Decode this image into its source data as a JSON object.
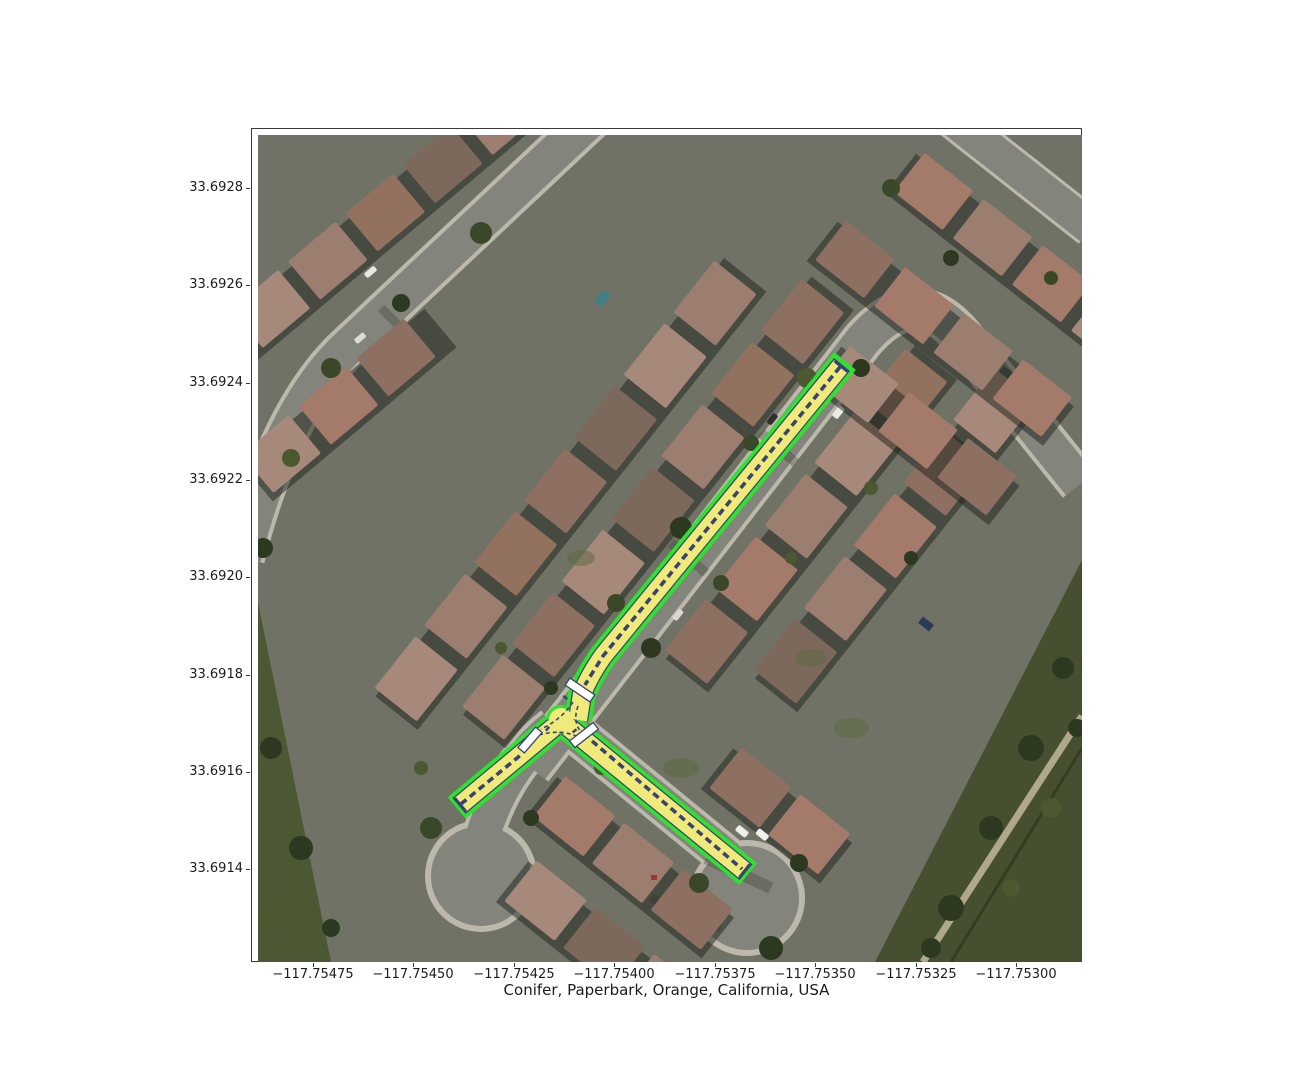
{
  "figure": {
    "xlabel": "Conifer, Paperbark, Orange, California, USA",
    "background_color": "#ffffff"
  },
  "axes": {
    "x_ticks": [
      "−117.75475",
      "−117.75450",
      "−117.75425",
      "−117.75400",
      "−117.75375",
      "−117.75350",
      "−117.75325",
      "−117.75300"
    ],
    "y_ticks": [
      "33.6928",
      "33.6926",
      "33.6924",
      "33.6922",
      "33.6920",
      "33.6918",
      "33.6916",
      "33.6914"
    ]
  },
  "map": {
    "type": "aerial-imagery-with-lane-overlay",
    "location": "Conifer, Paperbark, Orange, California, USA",
    "overlay": {
      "road_border_color": "#2fe22f",
      "lane_fill_color": "#f0ea7b",
      "lane_marking_color": "#3a4273",
      "crosswalk_color": "#ffffff",
      "roads": [
        {
          "name": "main-street-northeast-segment"
        },
        {
          "name": "west-cul-de-sac-segment"
        },
        {
          "name": "southeast-cul-de-sac-segment"
        }
      ],
      "intersection": {
        "type": "T-intersection",
        "crosswalk_count": 3
      }
    }
  }
}
